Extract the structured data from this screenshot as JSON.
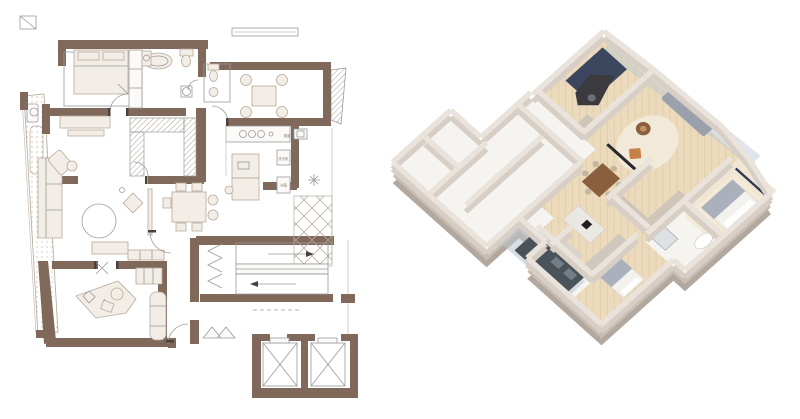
{
  "figure": {
    "name": "apartment floor plan — 2D drawing and 3D isometric render",
    "views": [
      {
        "id": "plan-2d",
        "type": "2D CAD floor plan",
        "position": "left"
      },
      {
        "id": "plan-3d",
        "type": "3D isometric cutaway render",
        "position": "right"
      }
    ]
  },
  "labels": {
    "washer": "洗衣机",
    "fridge": "冰箱",
    "flue": "烟道"
  },
  "rooms": [
    "master-bedroom",
    "master-bathroom",
    "walk-in-closet",
    "tea-room",
    "wc",
    "kitchen",
    "pantry",
    "service-balcony",
    "living-room",
    "dining-room",
    "office",
    "entry-hall",
    "stairwell",
    "elevator-lobby",
    "elevator-shafts",
    "side-balcony"
  ],
  "furniture_icons": [
    "double-bed",
    "bathtub",
    "toilet",
    "vanity-basin",
    "shower",
    "wardrobe-hatch",
    "tea-table-with-chairs",
    "gas-stove",
    "kitchen-island",
    "washing-machine",
    "fridge",
    "plant",
    "sofa",
    "chaise-chair",
    "round-rug",
    "armchair",
    "tv-console",
    "dining-table",
    "desk-with-chair",
    "stair-flights",
    "elevator-x",
    "shoe-bench"
  ],
  "palette": {
    "wall_brown": "#80685a",
    "furniture_fill": "#f2ede7",
    "furniture_stroke": "#b9aa9b",
    "line_gray": "#9a9a9a",
    "light_line": "#c6bfb6",
    "hatch_line": "#a39584",
    "label_gray": "#8a7f72",
    "iso_wall": "#d7cec6",
    "iso_wall_top": "#e9e3dc",
    "slab_side": "#b3a89e",
    "floor_white": "#f6f4f1",
    "floor_wood": "#ecdabc",
    "floor_light": "#f0e6d2",
    "rug_cream": "#f1ead9",
    "glass_blue": "#b9c6d0",
    "sofa_gray": "#9aa1ad",
    "navy": "#2d3a57",
    "orange": "#c8804a",
    "wood_dark": "#8a5f3d",
    "wood_mid": "#c09262",
    "cabinet_dark": "#4a525a",
    "marble": "#eae8e3",
    "blanket_gray": "#aab0bc"
  }
}
